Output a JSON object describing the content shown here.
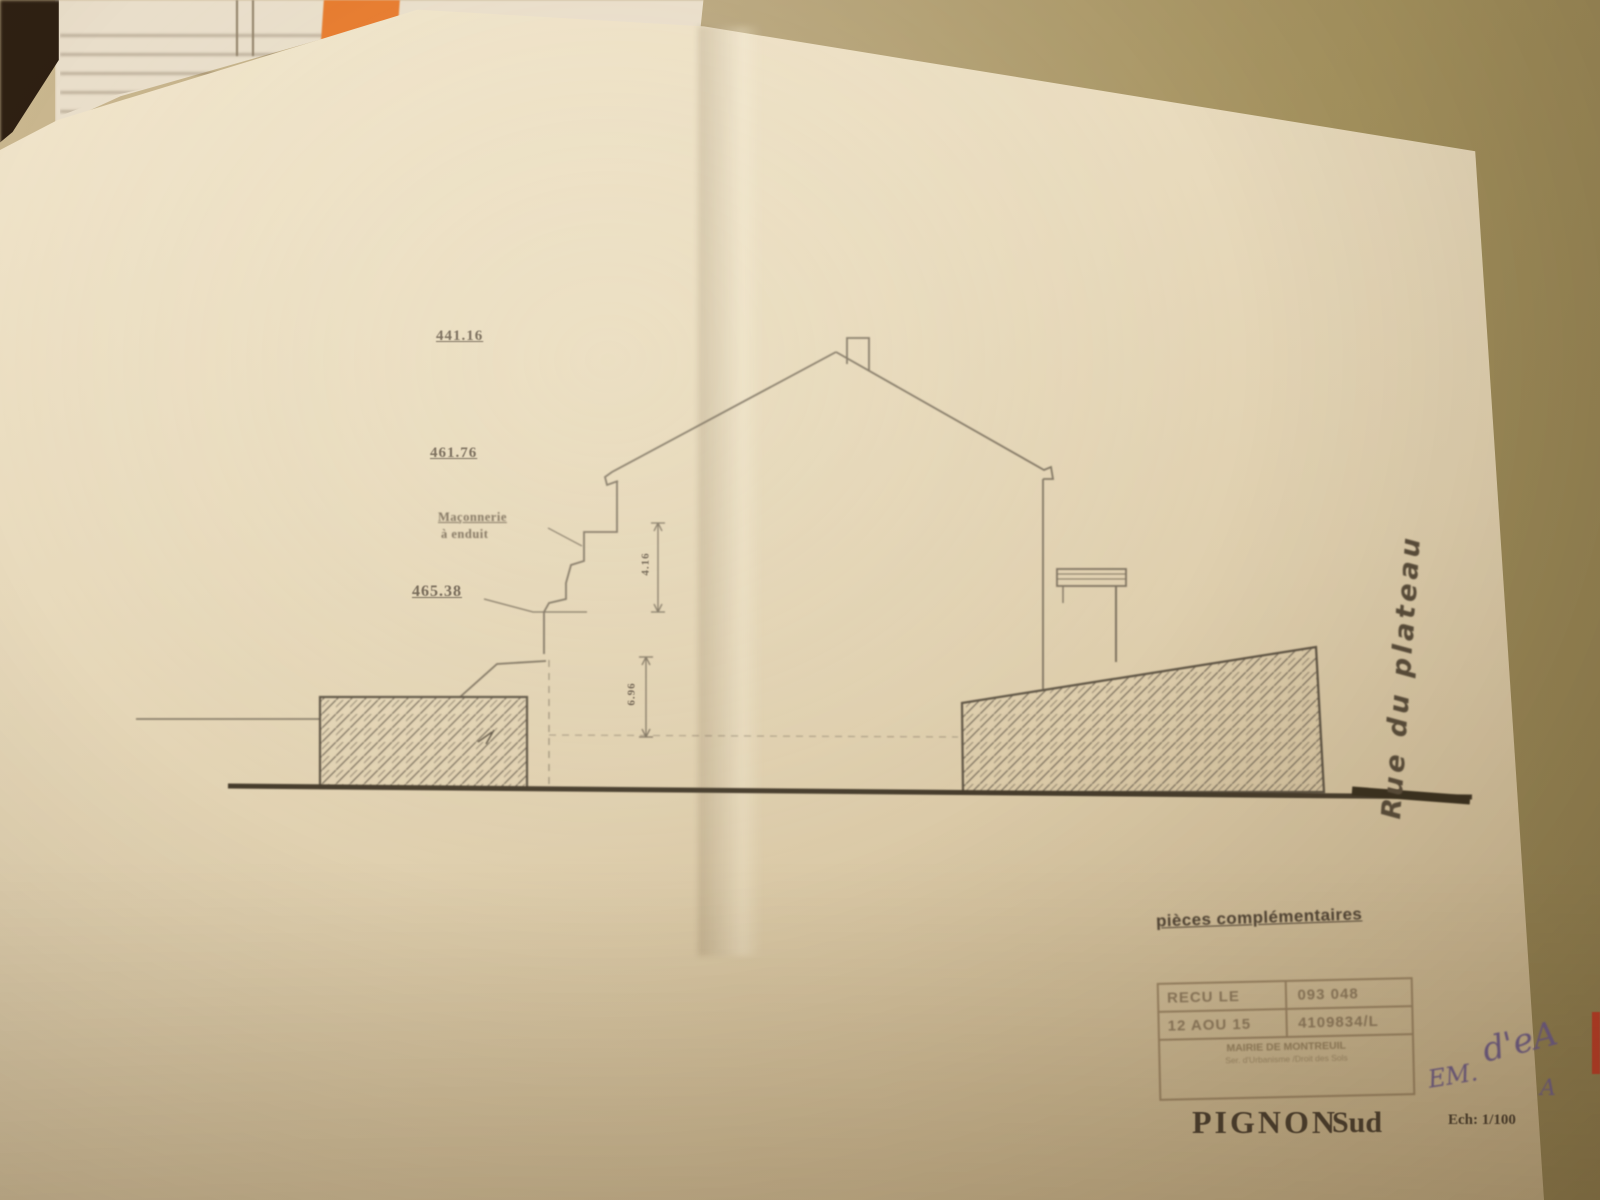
{
  "scene": {
    "desk_color": "#a5935f",
    "postit_color": "#e6792b",
    "red_sliver_color": "#c03824"
  },
  "drawing": {
    "elevation_top": "441.16",
    "elevation_mid": "461.76",
    "elevation_low": "465.38",
    "masonry_note_line1": "Maçonnerie",
    "masonry_note_line2": "à enduit",
    "dim_upper": "4.16",
    "dim_lower": "6.96",
    "street_label": "Rue du plateau",
    "pieces_label": "pièces complémentaires",
    "title_main": "PIGNON",
    "title_sub": "Sud",
    "scale_label": "Ech: 1/100"
  },
  "stamp": {
    "recu_le": "RECU LE",
    "number": "093 048",
    "date": "12 AOU 15",
    "ref": "4109834/L",
    "office_line1": "MAIRIE DE MONTREUIL",
    "office_line2": "Ser. d'Urbanisme /Droit des Sols"
  },
  "handwriting": {
    "mark1": "EM.",
    "mark2": "d'eA",
    "mark3": "A"
  }
}
